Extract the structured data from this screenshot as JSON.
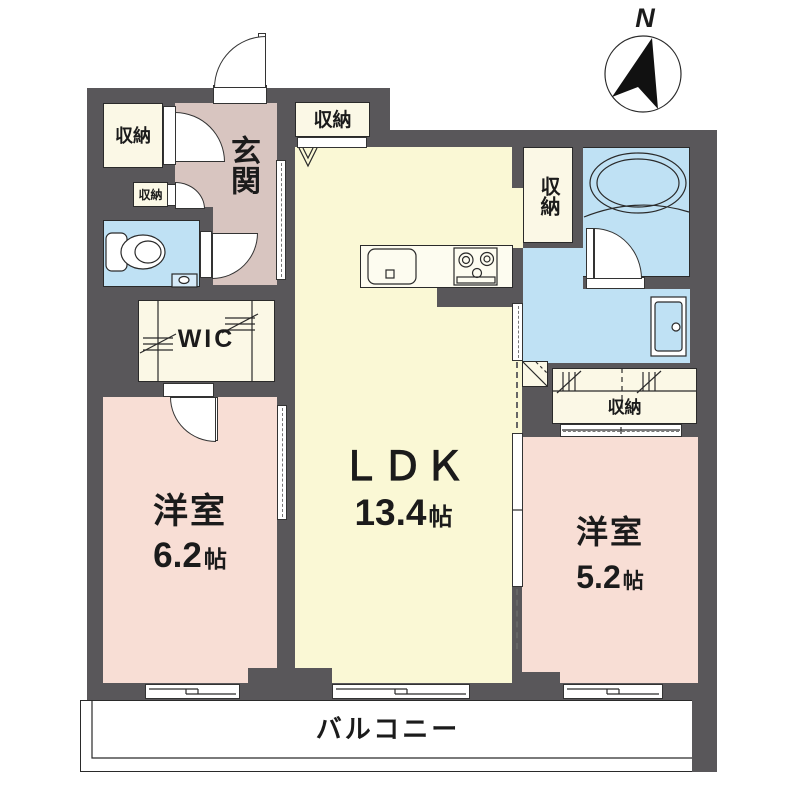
{
  "compass": {
    "north": "N"
  },
  "rooms": {
    "ldk": {
      "label": "ＬＤＫ",
      "size_num": "13.4",
      "size_unit": "帖"
    },
    "western_left": {
      "label": "洋室",
      "size_num": "6.2",
      "size_unit": "帖"
    },
    "western_right": {
      "label": "洋室",
      "size_num": "5.2",
      "size_unit": "帖"
    },
    "entrance": {
      "label": "玄関"
    },
    "wic": {
      "label": "WIC"
    },
    "balcony": {
      "label": "バルコニー"
    }
  },
  "closets": {
    "hall_large": {
      "label": "収納"
    },
    "hall_small": {
      "label": "収納"
    },
    "ldk_top": {
      "label": "収納"
    },
    "bath_side": {
      "label": "収納"
    },
    "bedroom_right": {
      "label": "収納"
    }
  },
  "colors": {
    "wall": "#59575a",
    "ldk_floor": "#faf8d5",
    "closet_floor": "#fbf8e6",
    "bedroom_floor": "#f8ded5",
    "entrance_floor": "#d8c5c0",
    "wet_area": "#bfe1f4",
    "balcony": "#ffffff",
    "line": "#1b1b1b"
  }
}
